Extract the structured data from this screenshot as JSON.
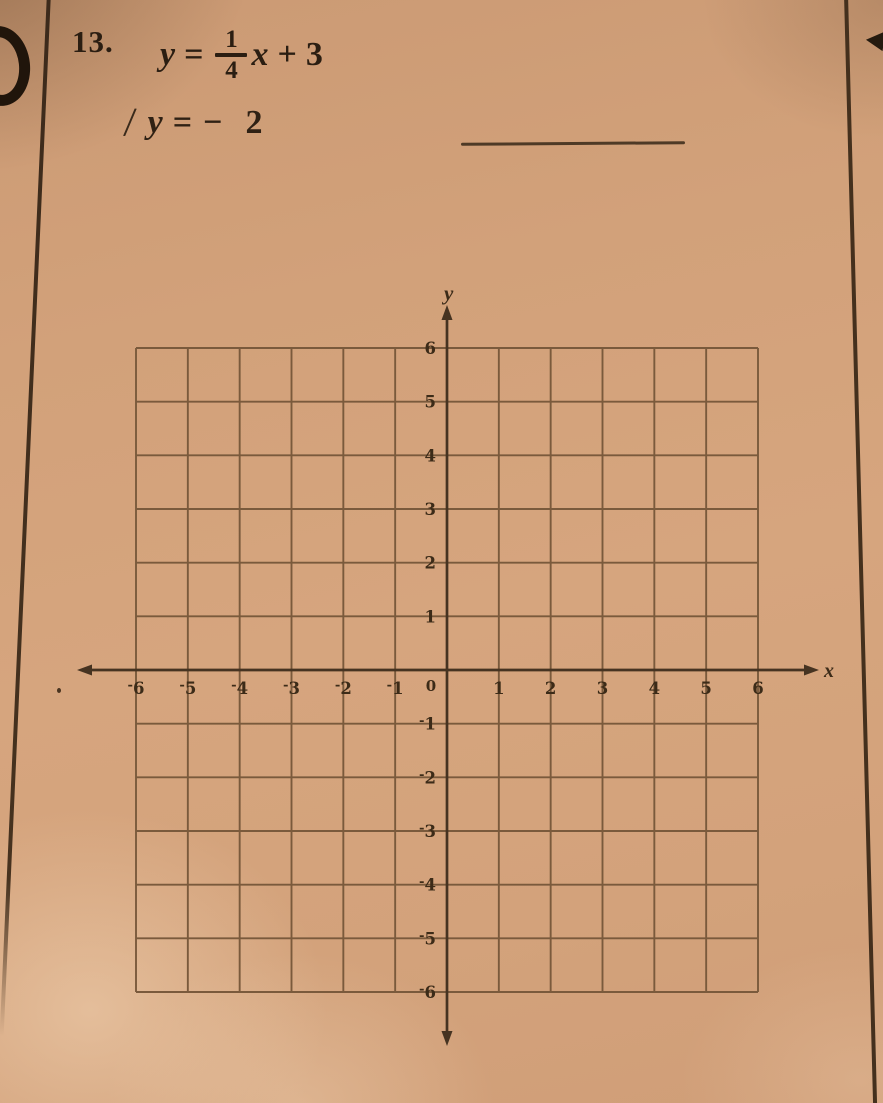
{
  "page": {
    "paper_color": "#d2a17a",
    "ink_color": "#2b1e12",
    "grid_line_color": "#7a5a3c",
    "axis_color": "#463321"
  },
  "problem": {
    "number": "13.",
    "equation1": {
      "lhs": "y",
      "equals": "=",
      "fraction": {
        "numerator": "1",
        "denominator": "4"
      },
      "variable": "x",
      "operator": "+",
      "constant": "3"
    },
    "stray_mark": "/",
    "equation2": {
      "lhs": "y",
      "equals": "=",
      "minus": "−",
      "constant": "2"
    }
  },
  "chart_data": {
    "type": "coordinate-grid",
    "title": "",
    "xlabel": "x",
    "ylabel": "y",
    "x_range": [
      -6,
      6
    ],
    "y_range": [
      -6,
      6
    ],
    "grid": true,
    "grid_step": 1,
    "x_tick_labels": [
      "⁻6",
      "⁻5",
      "⁻4",
      "⁻3",
      "⁻2",
      "⁻1",
      "0",
      "1",
      "2",
      "3",
      "4",
      "5",
      "6"
    ],
    "y_tick_labels_top_to_bottom": [
      "6",
      "5",
      "4",
      "3",
      "2",
      "1",
      "⁻1",
      "⁻2",
      "⁻3",
      "⁻4",
      "⁻5",
      "⁻6"
    ],
    "plotted_points": [],
    "equations_to_graph": [
      "y = 1/4 x + 3",
      "y = −2"
    ]
  }
}
